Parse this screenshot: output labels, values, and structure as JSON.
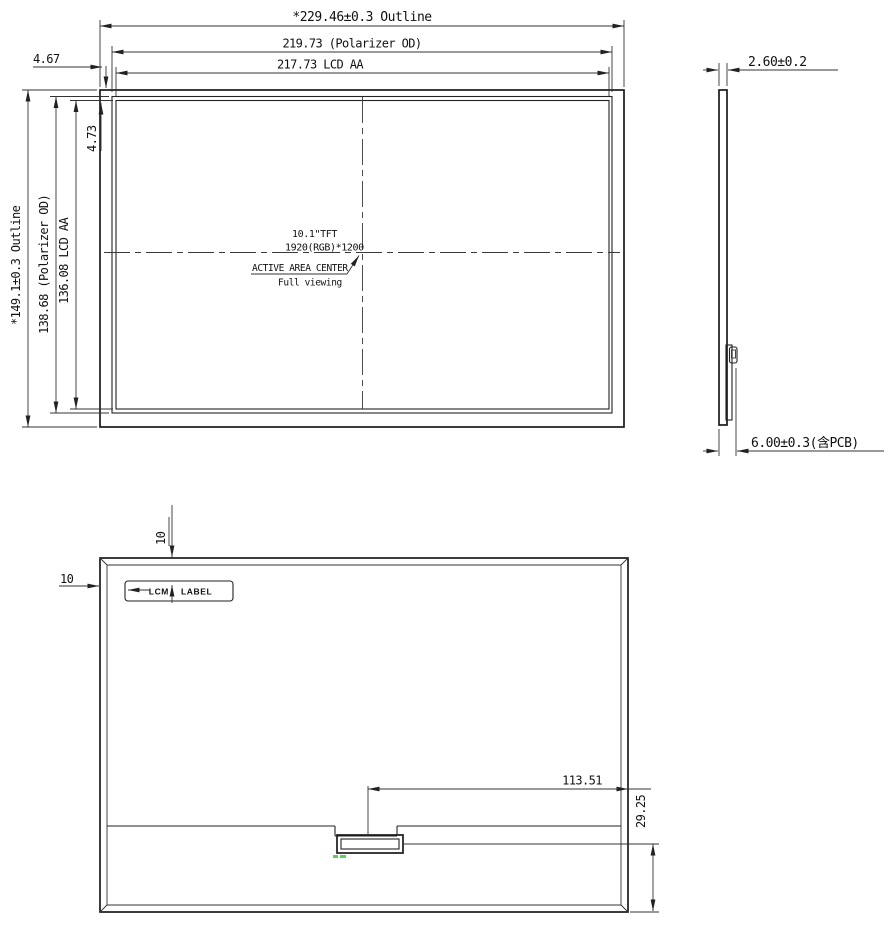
{
  "front_view": {
    "dim_width_outline": "*229.46±0.3 Outline",
    "dim_width_polarizer": "219.73  (Polarizer OD)",
    "dim_width_lcd": "217.73 LCD AA",
    "dim_height_outline": "*149.1±0.3  Outline",
    "dim_height_polarizer": "138.68 (Polarizer OD)",
    "dim_height_lcd": "136.08 LCD AA",
    "dim_edge_horizontal": "4.67",
    "dim_edge_vertical": "4.73",
    "center_note": {
      "line1": "10.1\"TFT",
      "line2": "1920(RGB)*1200",
      "line3": "ACTIVE AREA CENTER",
      "line4": "Full viewing"
    }
  },
  "side_view": {
    "dim_thickness_panel": "2.60±0.2",
    "dim_thickness_total": "6.00±0.3(含PCB)"
  },
  "rear_view": {
    "dim_label_from_top": "10",
    "dim_label_from_left": "10",
    "label_lcm": "LCM",
    "label_label": "LABEL",
    "dim_connector_from_right": "113.51",
    "dim_connector_from_bottom": "29.25"
  },
  "colors": {
    "line": "#1b1b1b",
    "background": "#ffffff",
    "accent_mark": "#5ecf5e"
  }
}
